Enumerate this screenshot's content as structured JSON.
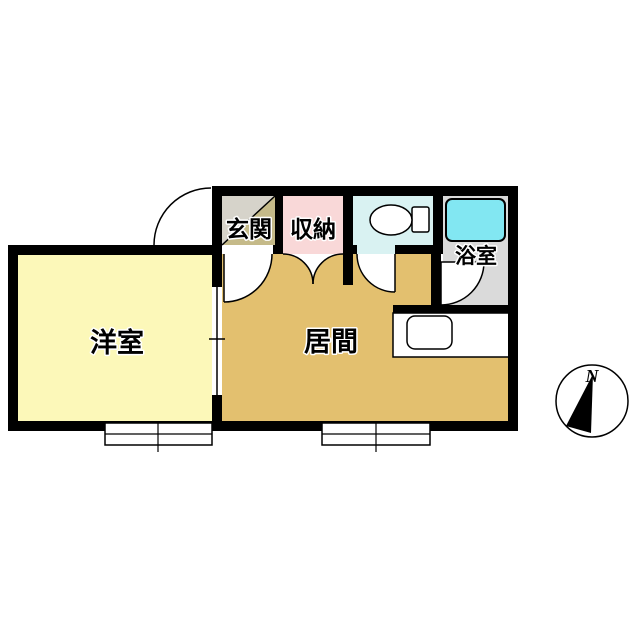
{
  "floor_plan": {
    "rooms": {
      "entrance": {
        "label": "玄関",
        "floor_color": "#d6d3ca",
        "step_color": "#c5ba89"
      },
      "storage": {
        "label": "収納",
        "floor_color": "#f9d8d8"
      },
      "toilet": {
        "floor_color": "#d9f2f2"
      },
      "bathroom": {
        "label": "浴室",
        "floor_color": "#dadada",
        "tub_color": "#82e7f2"
      },
      "western_room": {
        "label": "洋室",
        "floor_color": "#fcf8b9"
      },
      "living_room": {
        "label": "居間",
        "floor_color": "#e3c06f"
      },
      "kitchen": {
        "floor_color": "#ffffff"
      }
    },
    "compass": {
      "north_label": "N"
    },
    "colors": {
      "wall": "#000000",
      "line": "#000000",
      "background": "#ffffff",
      "fixture_fill": "#ffffff"
    }
  }
}
